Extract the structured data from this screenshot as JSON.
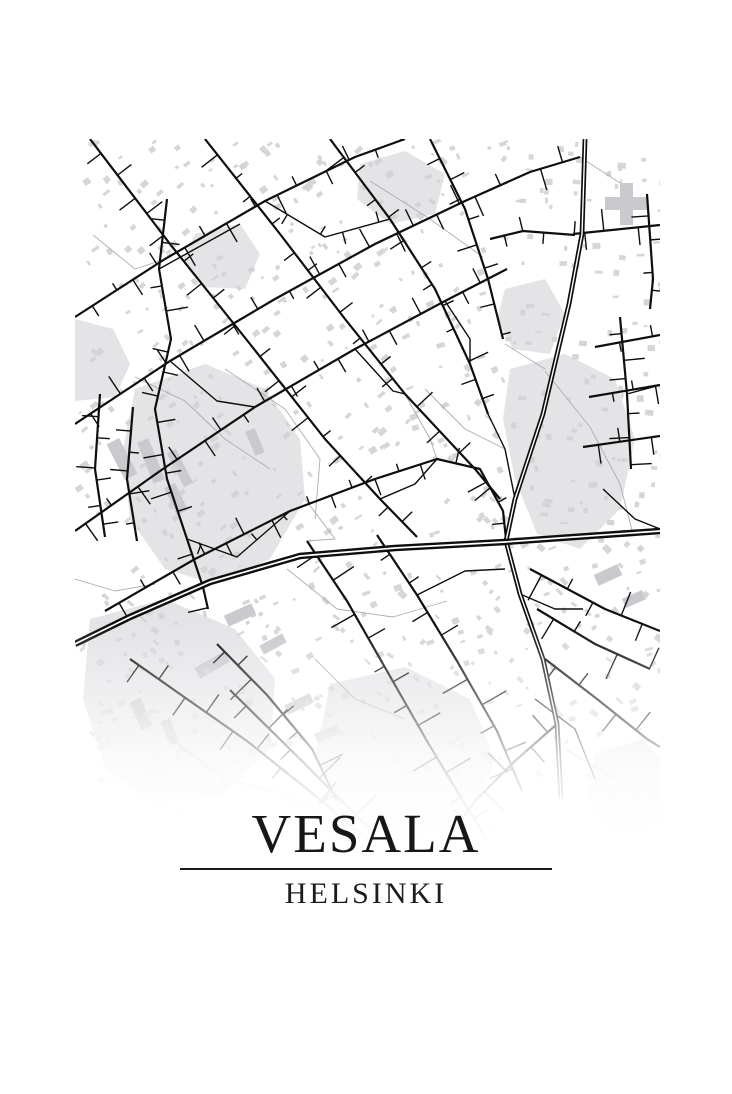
{
  "poster": {
    "title": "VESALA",
    "subtitle": "HELSINKI",
    "style": {
      "background": "#ffffff",
      "road_color": "#0e0e0e",
      "road_casing_white": "#ffffff",
      "area_color": "#e4e4e7",
      "building_color": "#d2d2d6",
      "large_building_color": "#c9c9ce",
      "path_color": "#adadb2",
      "text_color": "#171717",
      "divider_color": "#1a1a1a"
    }
  }
}
